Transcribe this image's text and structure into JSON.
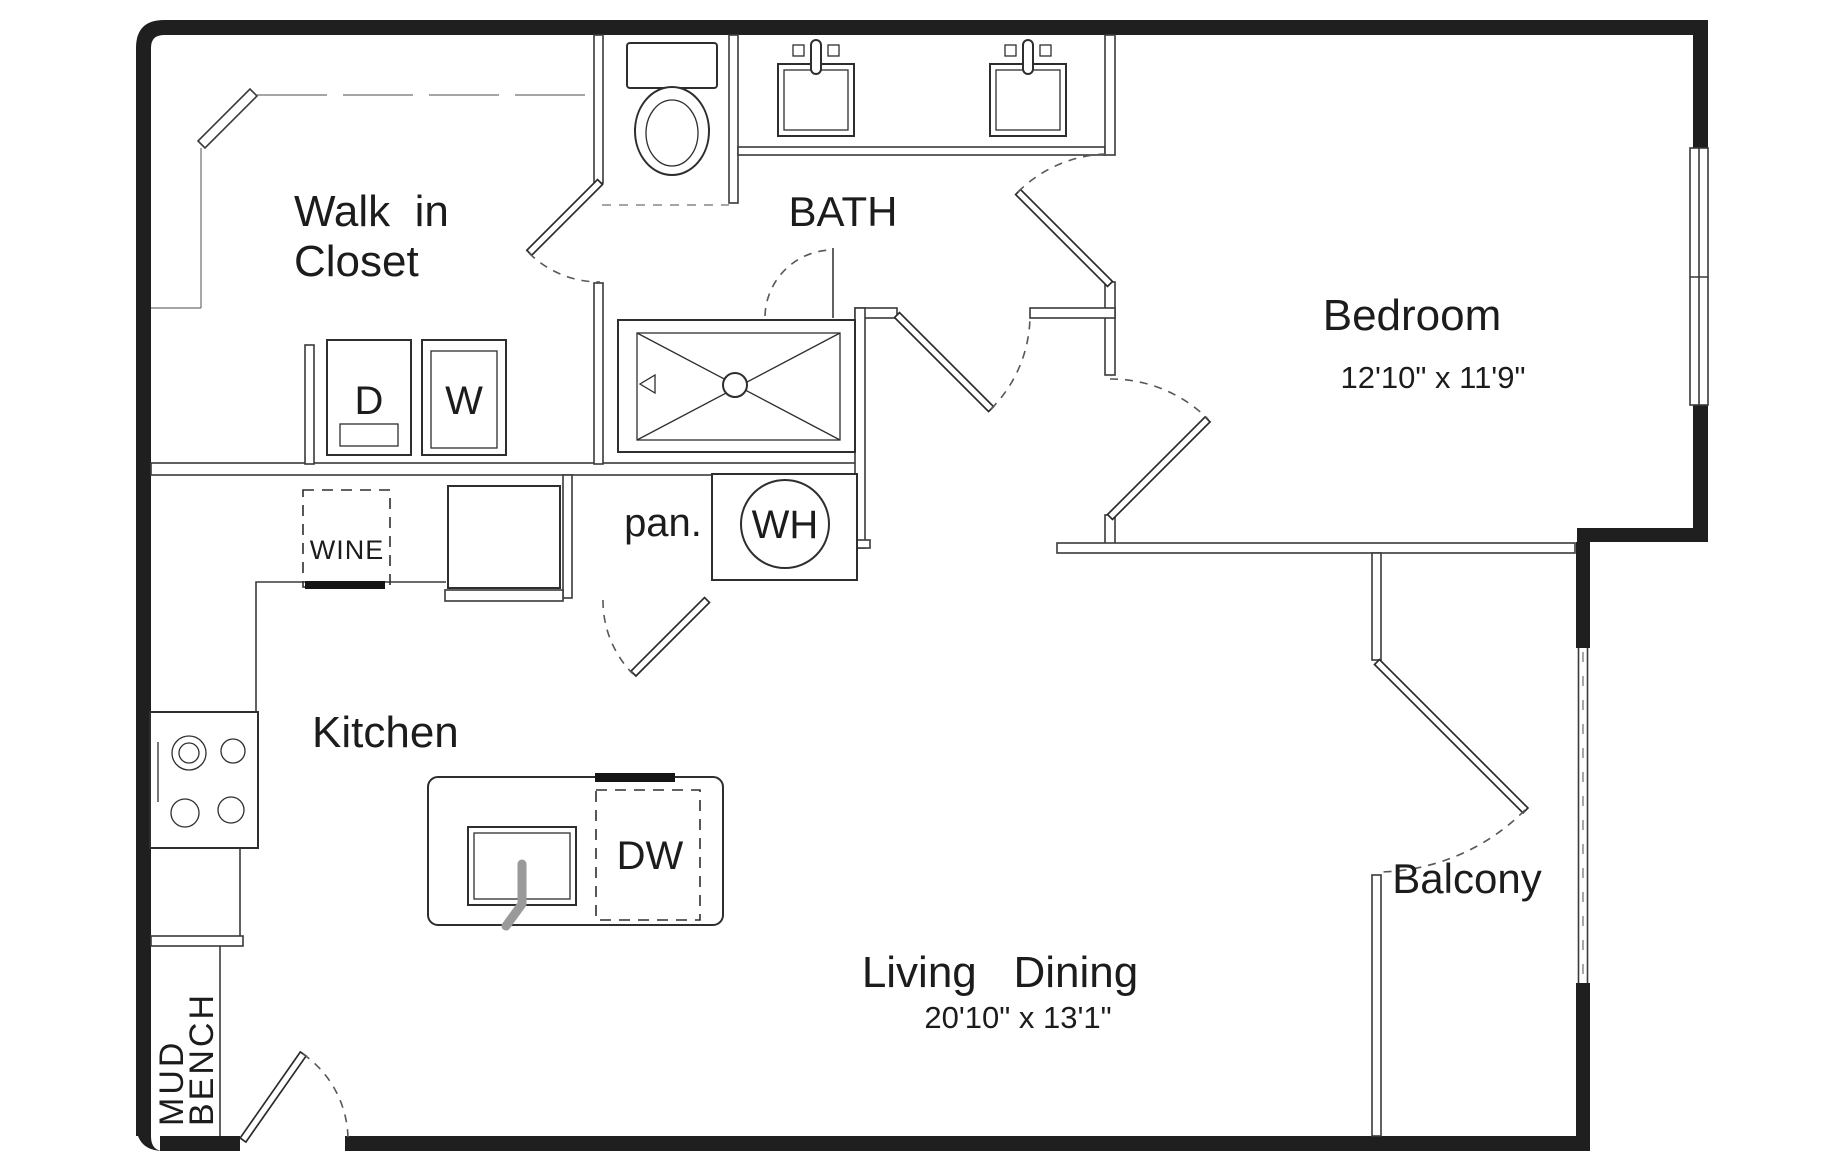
{
  "colors": {
    "ink": "#1f1f1f",
    "line": "#3a3a3a",
    "bg": "#ffffff",
    "dash": "#575757"
  },
  "rooms": {
    "closet": {
      "line1": "Walk  in",
      "line2": "Closet"
    },
    "bath": {
      "label": "BATH"
    },
    "bedroom": {
      "label": "Bedroom",
      "dims": "12'10\" x 11'9\""
    },
    "kitchen": {
      "label": "Kitchen"
    },
    "living": {
      "label": "Living   Dining",
      "dims": "20'10\" x 13'1\""
    },
    "balcony": {
      "label": "Balcony"
    },
    "pantry": {
      "label": "pan."
    },
    "mud": {
      "line1": "MUD",
      "line2": "BENCH"
    }
  },
  "appliances": {
    "dryer": "D",
    "washer": "W",
    "wine": "WINE",
    "water_heater": "WH",
    "dishwasher": "DW"
  }
}
